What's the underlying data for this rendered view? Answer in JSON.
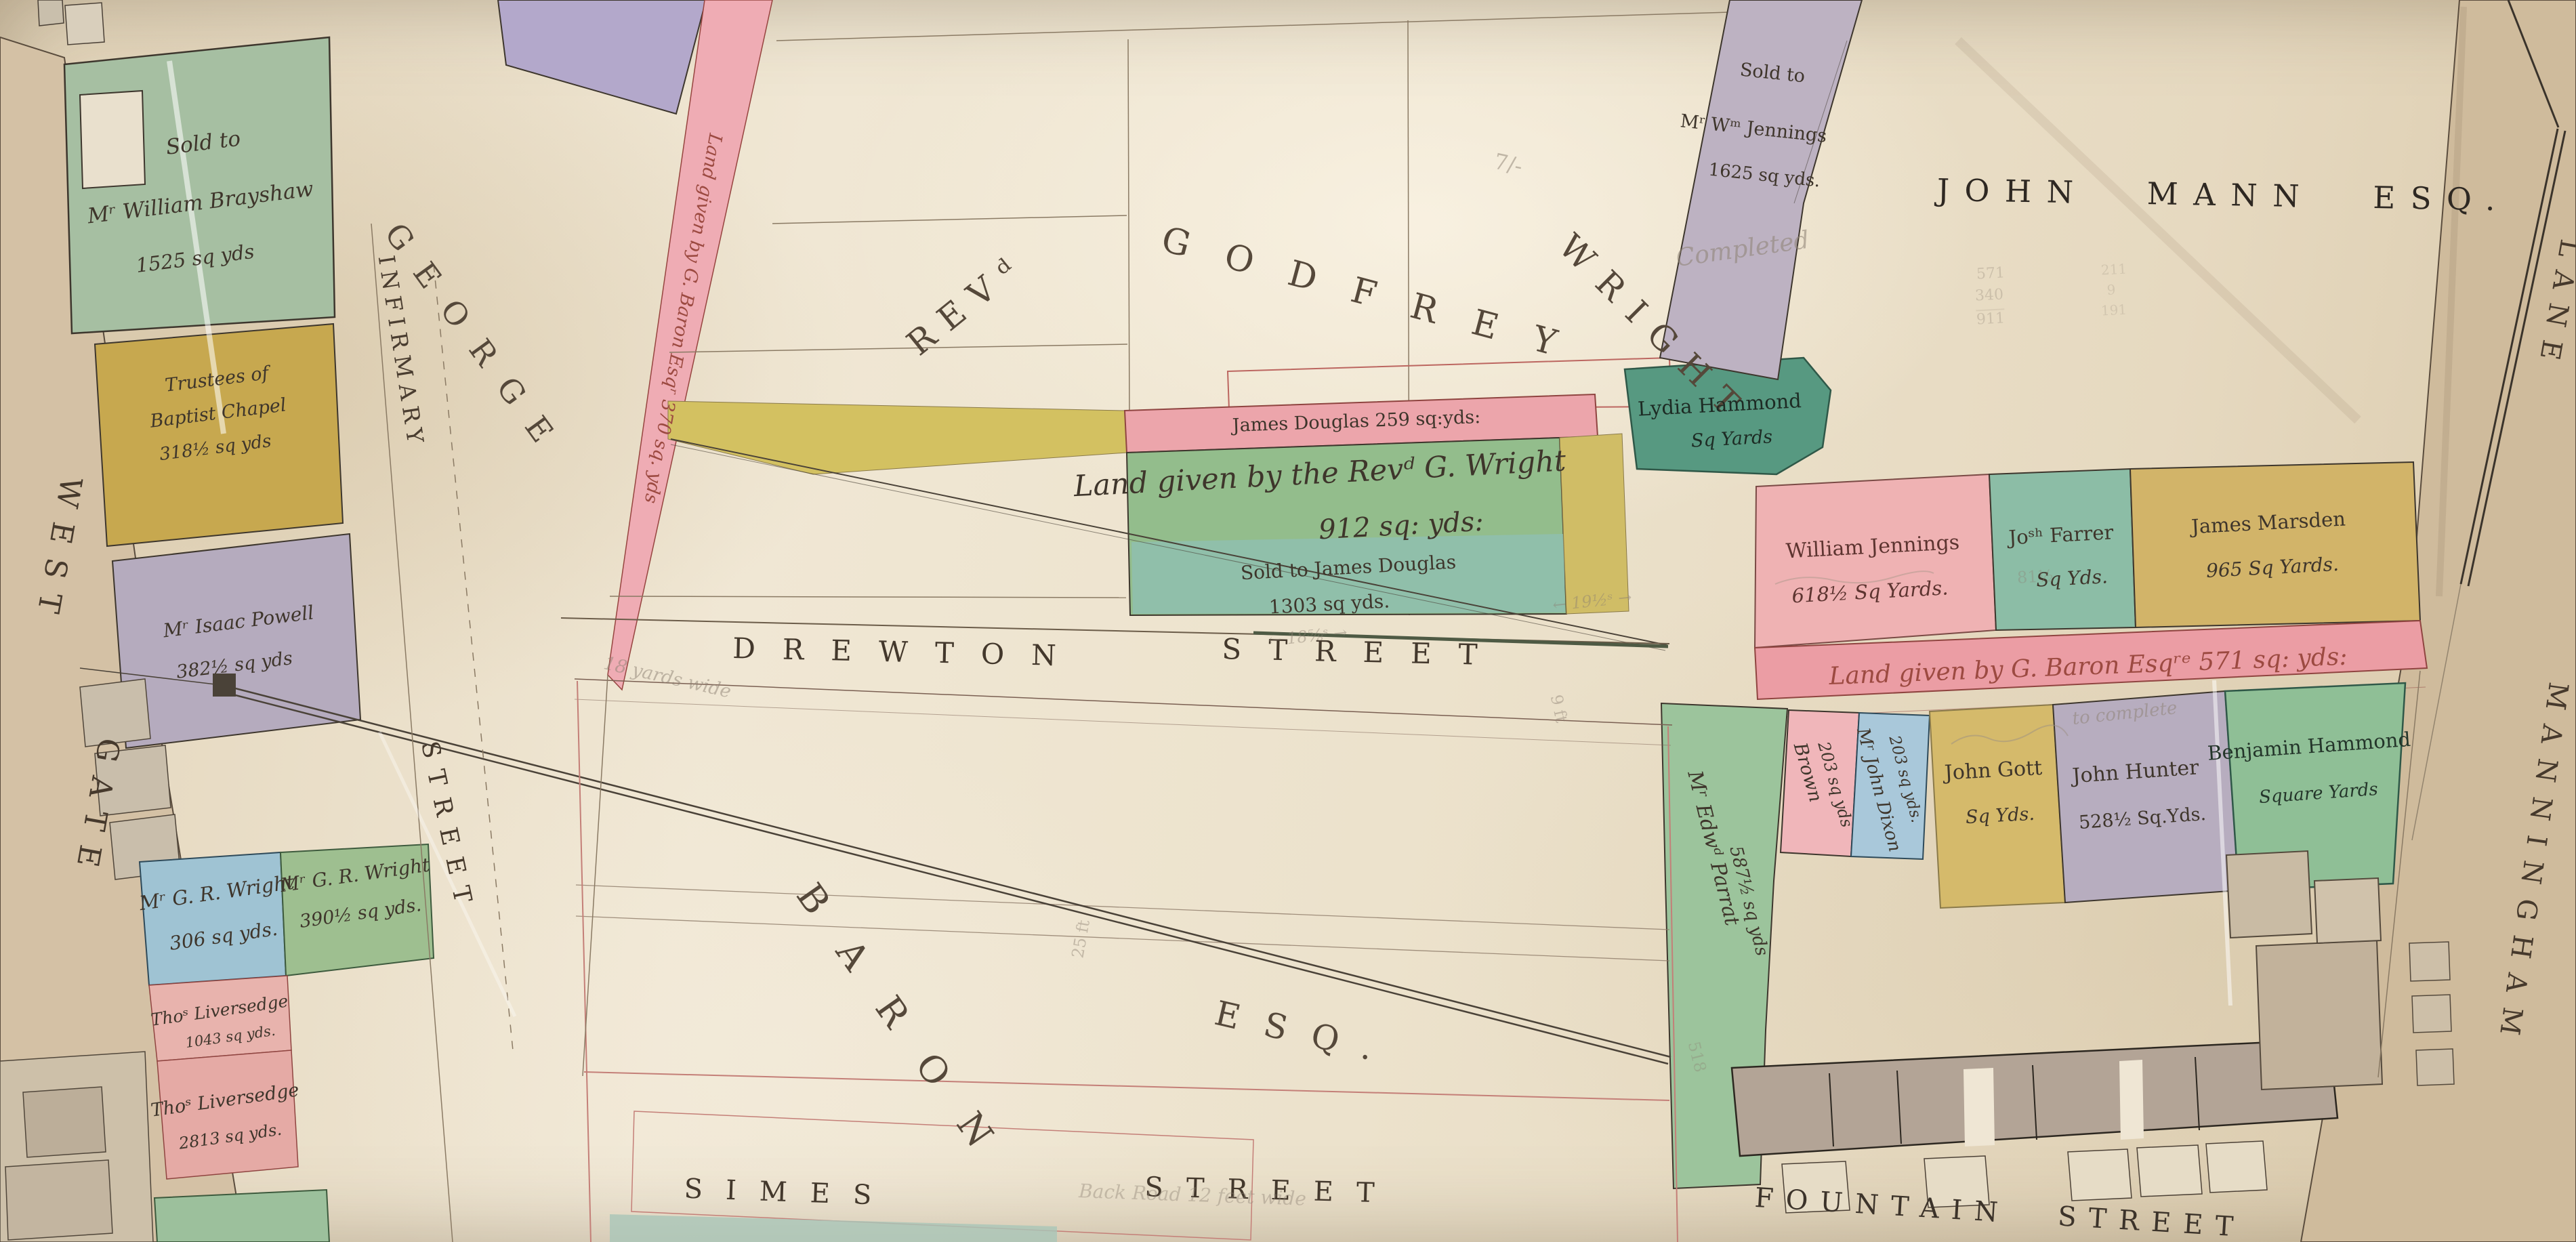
{
  "palette": {
    "paper": "#ece2cd",
    "street_tan": "#d3c0a4",
    "ink": "#44392e",
    "red_ink": "#9c4a41",
    "pencil": "#8d8173",
    "green": "#a6bfa2",
    "dark_green": "#579981",
    "teal": "#8fc0b4",
    "ochre": "#c7a84f",
    "yellow": "#d2b469",
    "pink": "#efb2b3",
    "deep_pink": "#eb9da4",
    "lavender": "#b5abbe",
    "purple": "#b3a8cb",
    "blue": "#9fc3d3"
  },
  "streets": {
    "westgate": [
      "WEST",
      "GATE"
    ],
    "infirmary": "INFIRMARY",
    "george": [
      "GEORGE",
      "STREET"
    ],
    "drewton": [
      "DREWTON",
      "STREET"
    ],
    "simes": [
      "SIMES",
      "STREET"
    ],
    "fountain": "FOUNTAIN STREET",
    "manningham": [
      "MANNINGHAM",
      "LANE"
    ]
  },
  "owners": {
    "revd": "REVᵈ",
    "godfrey": "GODFREY",
    "wright": "WRIGHT",
    "john_mann": "JOHN MANN ESQ.",
    "baron": "BARON",
    "baron_esq": "ESQ."
  },
  "plots": {
    "brayshaw": {
      "l1": "Sold to",
      "l2": "Mʳ William Brayshaw",
      "l3": "1525 sq yds"
    },
    "baptist": {
      "l1": "Trustees of",
      "l2": "Baptist Chapel",
      "l3": "318½ sq yds"
    },
    "powell": {
      "l1": "Mʳ Isaac Powell",
      "l2": "382½ sq yds"
    },
    "baron_gift_west": {
      "text": "Land given by G. Baron Esqʳ 370 sq. yds"
    },
    "douglas_strip": {
      "text": "James Douglas 259 sq:yds:"
    },
    "wright_gift": {
      "l1": "Land given by the Revᵈ G. Wright",
      "l2": "912 sq: yds:",
      "l3": "Sold to James Douglas",
      "l4": "1303 sq yds."
    },
    "lydia": {
      "l1": "Lydia Hammond",
      "l2": "Sq Yards"
    },
    "jennings_sold": {
      "l1": "Sold to",
      "l2": "Mʳ Wᵐ Jennings",
      "l3": "1625 sq yds."
    },
    "wjennings": {
      "l1": "William Jennings",
      "l2": "618½ Sq Yards."
    },
    "farrer": {
      "l1": "Joˢʰ Farrer",
      "l2": "Sq Yds."
    },
    "marsden": {
      "l1": "James Marsden",
      "l2": "965 Sq Yards."
    },
    "baron_gift_east": {
      "text": "Land given by G. Baron Esqʳᵉ 571 sq: yds:"
    },
    "parrat": {
      "l1": "Mʳ Edwᵈ Parrat",
      "l2": "587½ sq yds"
    },
    "brown": {
      "l1": "Brown",
      "l2": "203 sq yds"
    },
    "dixon": {
      "l1": "Mʳ John Dixon",
      "l2": "203 sq yds."
    },
    "gott": {
      "l1": "John Gott",
      "l2": "Sq Yds."
    },
    "hunter": {
      "l1": "John Hunter",
      "l2": "528½ Sq.Yds."
    },
    "hammond": {
      "l1": "Benjamin Hammond",
      "l2": "Square Yards"
    },
    "wright306": {
      "l1": "Mʳ G. R. Wright",
      "l2": "306 sq yds."
    },
    "wright390": {
      "l1": "Mʳ G. R. Wright",
      "l2": "390½ sq yds."
    },
    "liversedge1": {
      "l1": "Thoˢ Liversedge",
      "l2": "1043 sq yds."
    },
    "liversedge2": {
      "l1": "Thoˢ Liversedge",
      "l2": "2813 sq yds."
    }
  },
  "pencil": {
    "completed": "Completed",
    "to_complete": "to complete",
    "width18": "18 yards wide",
    "ft9": "9 ft",
    "ft25": "25 ft",
    "backroad": "Back Road 12 feet wide",
    "rate": "7/-",
    "dim1": "←  18⅝ˢ  →",
    "dim2": "←  19½ˢ  →",
    "sum1": [
      "571",
      "340",
      "911"
    ],
    "sum2": [
      "211",
      "9",
      "191"
    ],
    "p518": "518",
    "p81": "81½"
  }
}
